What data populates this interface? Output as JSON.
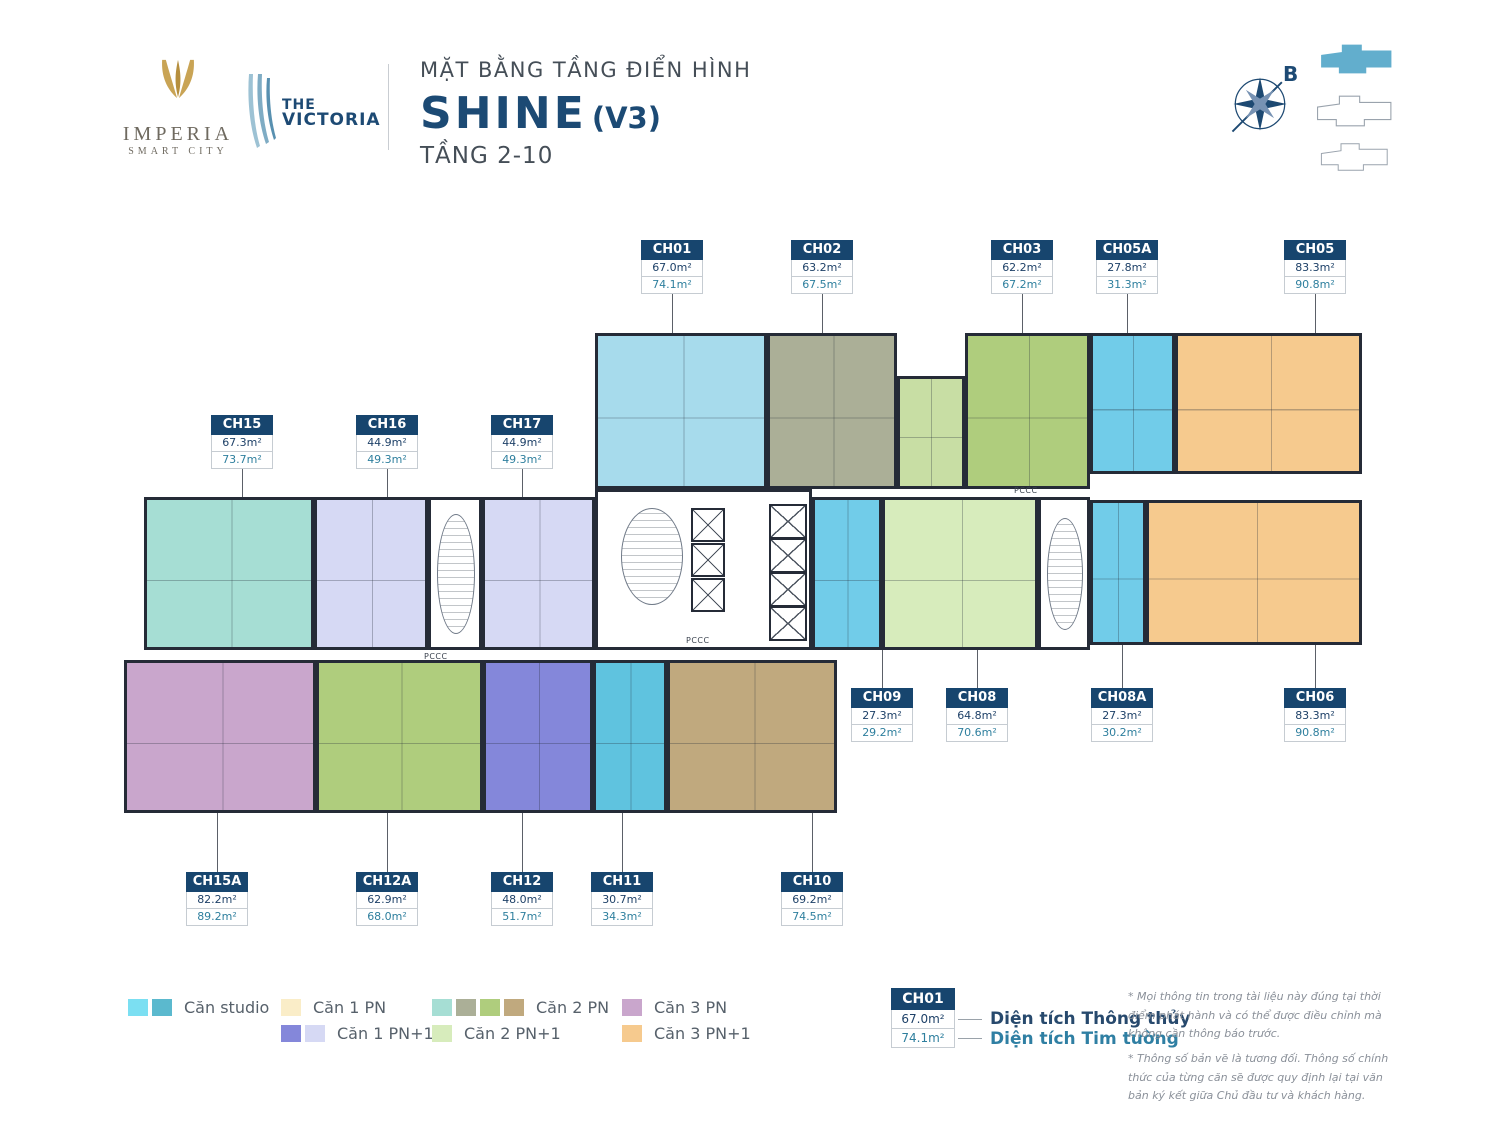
{
  "header": {
    "imperia_line1": "IMPERIA",
    "imperia_line2": "SMART CITY",
    "victoria_line1": "THE",
    "victoria_line2": "VICTORIA",
    "title_small": "MẶT BẰNG TẦNG ĐIỂN HÌNH",
    "title_main": "SHINE",
    "title_suffix": "(V3)",
    "title_sub": "TẦNG 2-10",
    "compass_label": "B"
  },
  "plan": {
    "core_label": "PCCC",
    "units": [
      {
        "id": "CH01",
        "net": "67.0m²",
        "gross": "74.1m²"
      },
      {
        "id": "CH02",
        "net": "63.2m²",
        "gross": "67.5m²"
      },
      {
        "id": "CH03",
        "net": "62.2m²",
        "gross": "67.2m²"
      },
      {
        "id": "CH05A",
        "net": "27.8m²",
        "gross": "31.3m²"
      },
      {
        "id": "CH05",
        "net": "83.3m²",
        "gross": "90.8m²"
      },
      {
        "id": "CH15",
        "net": "67.3m²",
        "gross": "73.7m²"
      },
      {
        "id": "CH16",
        "net": "44.9m²",
        "gross": "49.3m²"
      },
      {
        "id": "CH17",
        "net": "44.9m²",
        "gross": "49.3m²"
      },
      {
        "id": "CH09",
        "net": "27.3m²",
        "gross": "29.2m²"
      },
      {
        "id": "CH08",
        "net": "64.8m²",
        "gross": "70.6m²"
      },
      {
        "id": "CH08A",
        "net": "27.3m²",
        "gross": "30.2m²"
      },
      {
        "id": "CH06",
        "net": "83.3m²",
        "gross": "90.8m²"
      },
      {
        "id": "CH15A",
        "net": "82.2m²",
        "gross": "89.2m²"
      },
      {
        "id": "CH12A",
        "net": "62.9m²",
        "gross": "68.0m²"
      },
      {
        "id": "CH12",
        "net": "48.0m²",
        "gross": "51.7m²"
      },
      {
        "id": "CH11",
        "net": "30.7m²",
        "gross": "34.3m²"
      },
      {
        "id": "CH10",
        "net": "69.2m²",
        "gross": "74.5m²"
      }
    ]
  },
  "legend": {
    "studio": "Căn studio",
    "c1pn": "Căn 1 PN",
    "c1pn1": "Căn 1 PN+1",
    "c2pn": "Căn 2 PN",
    "c2pn1": "Căn 2 PN+1",
    "c3pn": "Căn 3 PN",
    "c3pn1": "Căn 3 PN+1"
  },
  "sample": {
    "id": "CH01",
    "net": "67.0m²",
    "gross": "74.1m²",
    "net_label": "Diện tích Thông thủy",
    "gross_label": "Diện tích Tim tường"
  },
  "notes": [
    "* Mọi thông tin trong tài liệu này đúng tại thời điểm phát hành và có thể được điều chỉnh mà không cần thông báo trước.",
    "* Thông số bản vẽ là tương đối. Thông số chính thức của từng căn sẽ được quy định lại tại văn bản ký kết giữa Chủ đầu tư và khách hàng."
  ],
  "palette": {
    "wall": "#252b37",
    "studio_light": "#7bdff2",
    "studio_dark": "#5bb9ce",
    "studio_cyan": "#71cce9",
    "studio_blue": "#5fc3df",
    "c1pn": "#faedc8",
    "c1pn1_dark": "#8487da",
    "c1pn1_light": "#d6d9f4",
    "c2pn_teal": "#a6ded4",
    "c2pn_grey": "#abaf97",
    "c2pn_green": "#afcd7d",
    "c2pn_green_pale": "#c8dea4",
    "c2pn_tan": "#c0a97e",
    "c2pn_blue": "#a7dbec",
    "c2pn1": "#d7ecbc",
    "c3pn": "#c9a6cc",
    "c3pn1": "#f6ca8e",
    "keyplan_highlight": "#62aecd"
  }
}
